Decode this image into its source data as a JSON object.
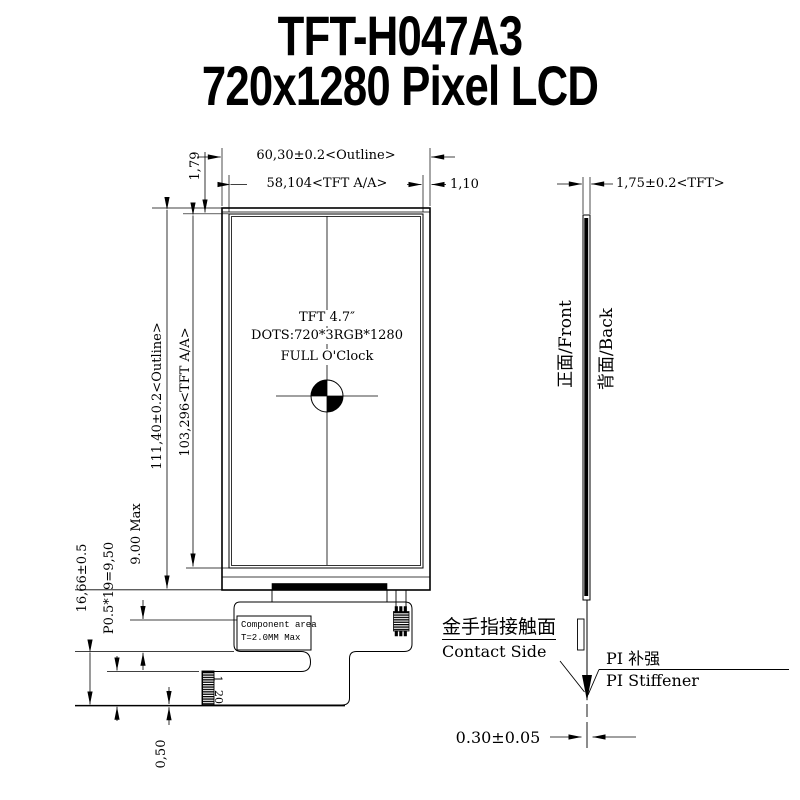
{
  "title": {
    "line1": "TFT-H047A3",
    "line2": "720x1280 Pixel LCD"
  },
  "front_view": {
    "dim_outline_width": "60,30±0.2<Outline>",
    "dim_aa_width": "58,104<TFT A/A>",
    "dim_edge_right": "1,10",
    "dim_edge_top": "1,79",
    "dim_outline_height": "111,40±0.2<Outline>",
    "dim_aa_height": "103,296<TFT A/A>",
    "panel_label_line1": "TFT 4.7″",
    "panel_label_line2": "DOTS:720*3RGB*1280",
    "panel_label_line3": "FULL O'Clock"
  },
  "fpc": {
    "dim_total": "16,66±0.5",
    "dim_pitch": "P0.5*19=9,50",
    "dim_component": "9.00 Max",
    "dim_tail": "0,50",
    "component_area_line1": "Component area",
    "component_area_line2": "T=2.0MM Max",
    "pin_first": "1",
    "pin_last": "20"
  },
  "side_view": {
    "dim_thickness": "1,75±0.2<TFT>",
    "front_label": "正面/Front",
    "back_label": "背面/Back",
    "contact_label_cn": "金手指接触面",
    "contact_label_en": "Contact Side",
    "stiffener_label_cn": "PI 补强",
    "stiffener_label_en": "PI Stiffener",
    "dim_fpc_thickness": "0.30±0.05"
  },
  "colors": {
    "line": "#000000",
    "background": "#ffffff"
  }
}
